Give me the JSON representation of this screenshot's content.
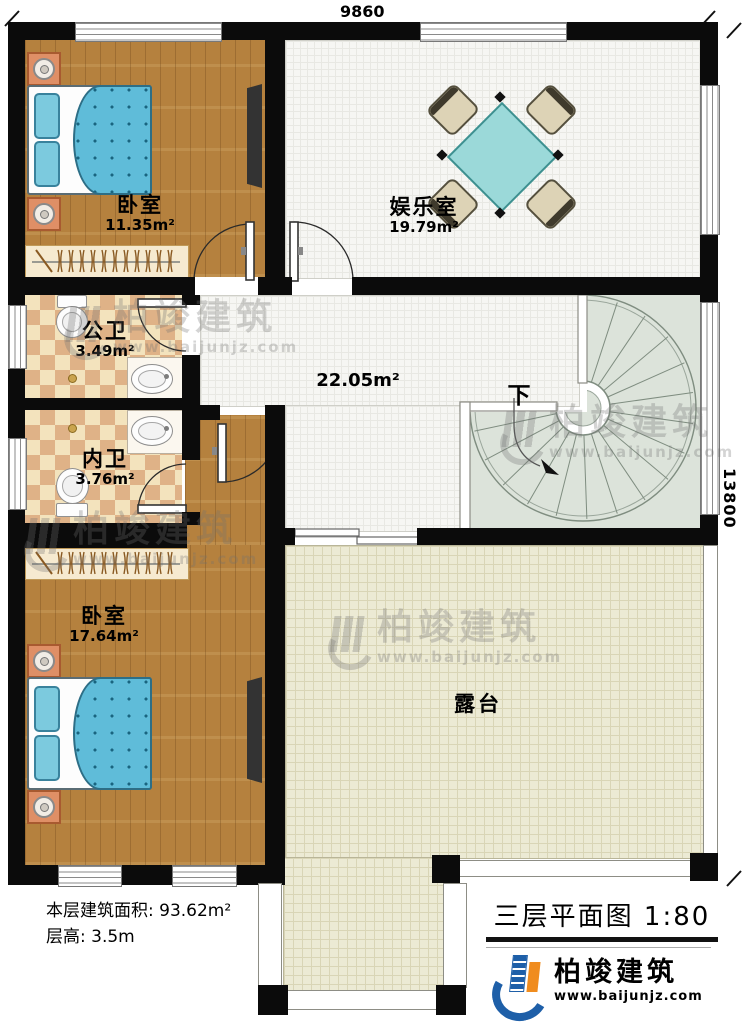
{
  "dimensions": {
    "top": "9860",
    "right": "13800"
  },
  "rooms": {
    "bedroom_top": {
      "name": "卧室",
      "area": "11.35m²"
    },
    "entertainment": {
      "name": "娱乐室",
      "area": "19.79m²"
    },
    "public_bathroom": {
      "name": "公卫",
      "area": "3.49m²"
    },
    "private_bathroom": {
      "name": "内卫",
      "area": "3.76m²"
    },
    "bedroom_bottom": {
      "name": "卧室",
      "area": "17.64m²"
    },
    "hallway": {
      "area": "22.05m²"
    },
    "terrace": {
      "name": "露台"
    },
    "staircase": {
      "direction_label": "下"
    }
  },
  "footer": {
    "floor_area_line": "本层建筑面积: 93.62m²",
    "floor_height_line": "层高: 3.5m",
    "title": "三层平面图 1:80"
  },
  "logo": {
    "brand": "柏竣建筑",
    "website": "www.baijunjz.com"
  },
  "watermark": {
    "brand": "柏竣建筑",
    "website": "www.baijunjz.com"
  },
  "colors": {
    "wall": "#0b0b0b",
    "wood_floor": "#b5813e",
    "tile_floor": "#f6f6f3",
    "bath_tile_light": "#f3e3bd",
    "bath_tile_dark": "#dfb287",
    "terrace_tile": "#ecead4",
    "stair_floor": "#dce3da",
    "bed": "#5fbcd9",
    "table": "#9bd9d9",
    "logo_blue": "#1e5fa8",
    "logo_orange": "#f08c1e"
  }
}
